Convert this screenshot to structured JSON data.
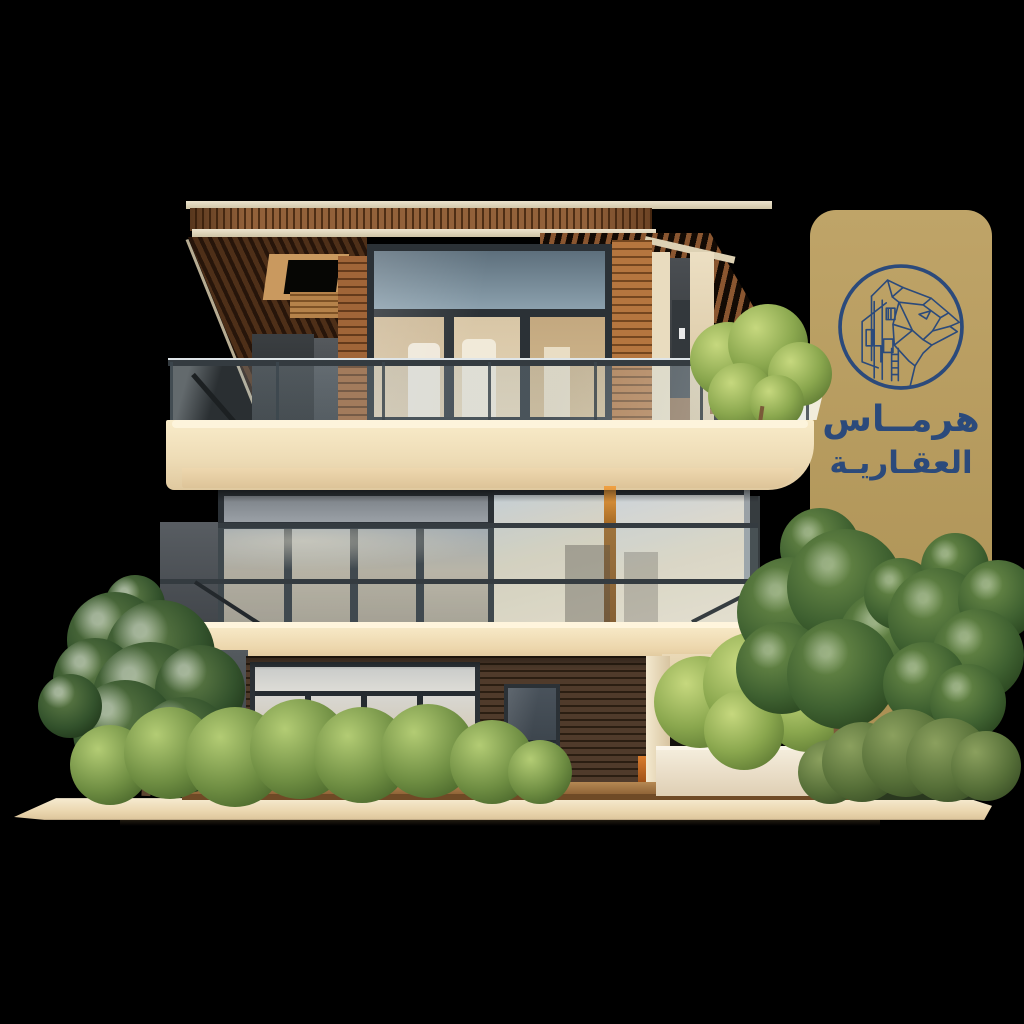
{
  "scene": {
    "type": "3d-architectural-render",
    "subject": "Modern three-storey villa with wood slat roof, glass balustrades, cream concrete slabs, trees and hedges on a transparent black background",
    "background_color": "#000000"
  },
  "brand_badge": {
    "line1": "هرمــاس",
    "line2": "العقـاريـة",
    "emblem": "geometric-panther-and-buildings-circle-emblem",
    "badge_color": "#b69b5d",
    "text_color": "#2b4a7b"
  },
  "colors": {
    "bg": "#000000",
    "gold": "#bfa468",
    "gold2": "#a98e51",
    "navy": "#2b4a7b",
    "cream": "#f4e2c0",
    "cream_dark": "#e2cba2",
    "wood": "#9c6b3d",
    "wood_dark": "#5f3c1e",
    "siding_dark": "#46342a",
    "frame_dark": "#2d3339",
    "glass_cool": "#9fb4c2",
    "glass_warm": "#e3d5bb",
    "leaf_dark": "#2f4a27",
    "leaf_mid": "#5d7f3f",
    "leaf_light": "#93b05e",
    "concrete_gray": "#4b5054"
  }
}
